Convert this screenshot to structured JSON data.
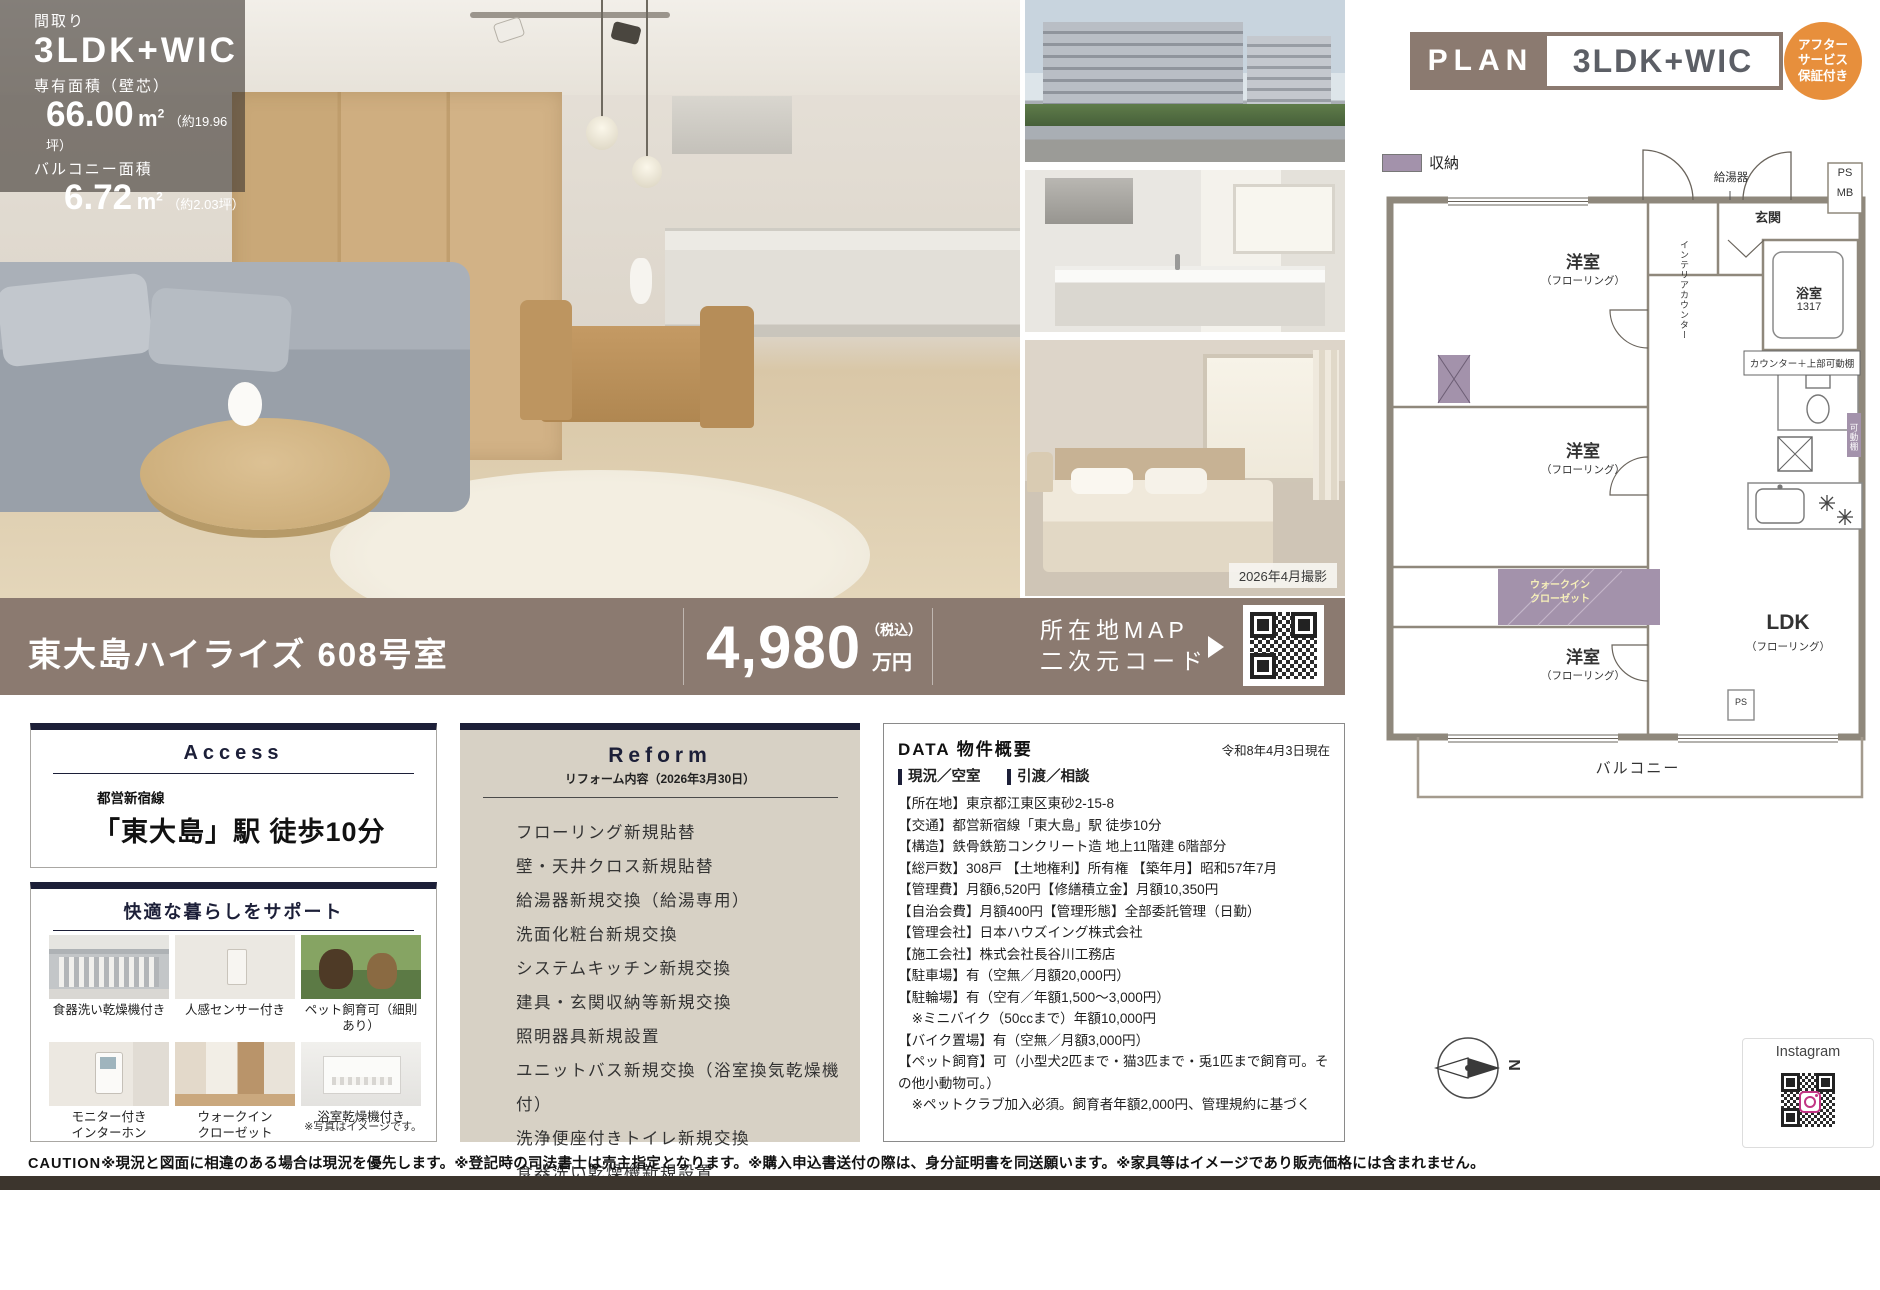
{
  "overlay": {
    "madori_label": "間取り",
    "madori_value": "3LDK+WIC",
    "area_label": "専有面積（壁芯）",
    "area_value": "66.00",
    "unit_base": "m",
    "unit_sup": "2",
    "area_note": "（約19.96坪）",
    "balcony_label": "バルコニー面積",
    "balcony_value": "6.72",
    "balcony_note": "（約2.03坪）"
  },
  "side_photos": {
    "shooting_date": "2026年4月撮影"
  },
  "title_bar": {
    "property_name": "東大島ハイライズ 608号室",
    "price": "4,980",
    "price_tax_note": "（税込）",
    "price_unit": "万円",
    "map_note": "スマホで確認",
    "map_line1": "所在地MAP",
    "map_line2": "二次元コード"
  },
  "access": {
    "title": "Access",
    "line_name": "都営新宿線",
    "station": "「東大島」駅 徒歩10分"
  },
  "support": {
    "title": "快適な暮らしをサポート",
    "items": [
      "食器洗い乾燥機付き",
      "人感センサー付き",
      "ペット飼育可（細則あり）",
      "モニター付き\nインターホン",
      "ウォークイン\nクローゼット",
      "浴室乾燥機付き"
    ],
    "note": "※写真はイメージです。"
  },
  "reform": {
    "title": "Reform",
    "subtitle": "リフォーム内容（2026年3月30日）",
    "items": [
      "フローリング新規貼替",
      "壁・天井クロス新規貼替",
      "給湯器新規交換（給湯専用）",
      "洗面化粧台新規交換",
      "システムキッチン新規交換",
      "建具・玄関収納等新規交換",
      "照明器具新規設置",
      "ユニットバス新規交換（浴室換気乾燥機付）",
      "洗浄便座付きトイレ新規交換",
      "食器洗い乾燥機新規設置"
    ]
  },
  "data_section": {
    "title": "DATA 物件概要",
    "date": "令和8年4月3日現在",
    "status": "現況／空室",
    "handover": "引渡／相談",
    "rows": [
      "【所在地】東京都江東区東砂2-15-8",
      "【交通】都営新宿線「東大島」駅 徒歩10分",
      "【構造】鉄骨鉄筋コンクリート造 地上11階建 6階部分",
      "【総戸数】308戸 【土地権利】所有権 【築年月】昭和57年7月",
      "【管理費】月額6,520円【修繕積立金】月額10,350円",
      "【自治会費】月額400円【管理形態】全部委託管理（日勤）",
      "【管理会社】日本ハウズイング株式会社",
      "【施工会社】株式会社長谷川工務店",
      "【駐車場】有（空無／月額20,000円）",
      "【駐輪場】有（空有／年額1,500～3,000円）",
      "　※ミニバイク（50ccまで）年額10,000円",
      "【バイク置場】有（空無／月額3,000円）",
      "【ペット飼育】可（小型犬2匹まで・猫3匹まで・兎1匹まで飼育可。その他小動物可。）",
      "　※ペットクラブ加入必須。飼育者年額2,000円、管理規約に基づく"
    ]
  },
  "plan": {
    "header_label": "PLAN",
    "header_type": "3LDK+WIC",
    "badge_line1": "アフター",
    "badge_line2": "サービス",
    "badge_line3": "保証付き",
    "legend_label": "収納",
    "labels": {
      "genkan": "玄関",
      "kyutoki": "給湯器",
      "ps": "PS",
      "mb": "MB",
      "room": "洋室",
      "flooring": "（フローリング）",
      "bath": "浴室",
      "bath_size": "1317",
      "interior_counter": "インテリアカウンター",
      "counter_shelf": "カウンター＋上部可動棚",
      "kadodana": "可動棚",
      "wic": "ウォークイン\nクローゼット",
      "ldk": "LDK",
      "ps2": "PS",
      "balcony": "バルコニー",
      "compass": "N",
      "instagram": "Instagram"
    }
  },
  "caution": {
    "label": "CAUTION",
    "text": "※現況と図面に相違のある場合は現況を優先します。※登記時の司法書士は売主指定となります。※購入申込書送付の際は、身分証明書を同送願います。※家具等はイメージであり販売価格には含まれません。"
  }
}
